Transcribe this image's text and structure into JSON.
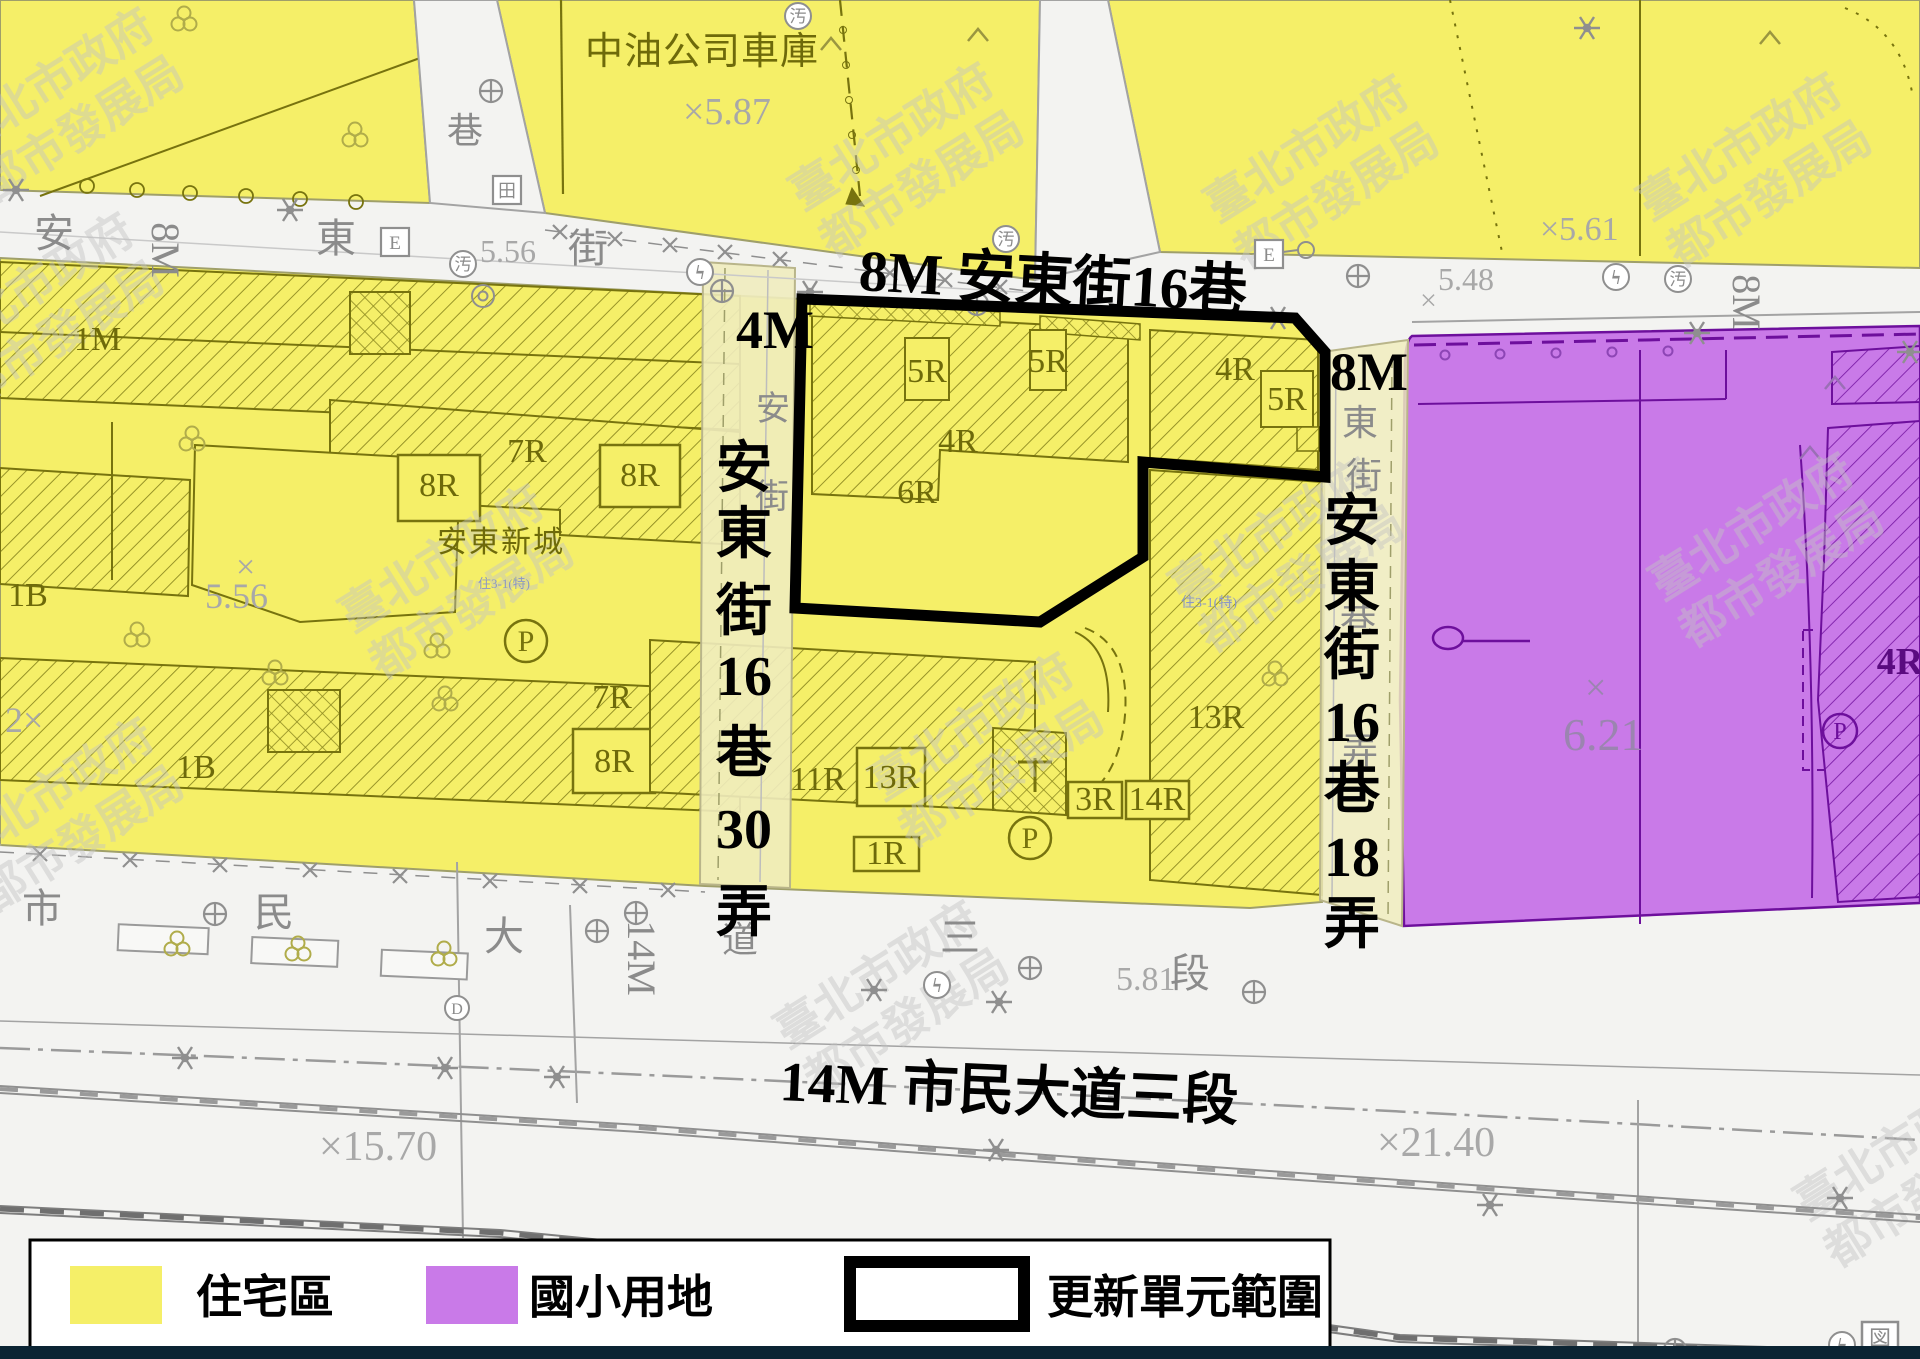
{
  "streets": {
    "andong_lane16": "8M  安東街16巷",
    "width_4m": "4M",
    "width_8m": "8M",
    "civic_blvd": "14M  市民大道三段",
    "lane30_chars": [
      "安",
      "東",
      "街",
      "16",
      "巷",
      "30",
      "弄"
    ],
    "lane18_chars": [
      "安",
      "東",
      "街",
      "16",
      "巷",
      "18",
      "弄"
    ],
    "gray": {
      "an": "安",
      "dong": "東",
      "jie": "街",
      "xiang": "巷",
      "nong": "弄",
      "dao": "道",
      "shi": "市",
      "min": "民",
      "da": "大",
      "san": "三",
      "duan": "段",
      "m8": "8M",
      "m14": "14M"
    }
  },
  "areas": {
    "cpc_depot": "中油公司車庫",
    "andong_village": "安東新城",
    "zoning_note": "住3-1(特)"
  },
  "elevations": {
    "e587": "×5.87",
    "e561": "×5.61",
    "e556_big": "5.56",
    "e556_x": "×",
    "e556_road": "5.56",
    "e548": "5.48",
    "x": "×",
    "e581": "5.81",
    "e621": "6.21",
    "e1570": "×15.70",
    "e2140": "×21.40",
    "e2x": "2×"
  },
  "parcels": {
    "m1": "1M",
    "b1": "1B",
    "r1": "1R",
    "r3": "3R",
    "r4": "4R",
    "r5": "5R",
    "r6": "6R",
    "r7": "7R",
    "r8": "8R",
    "r11": "11R",
    "r13": "13R",
    "r14": "14R"
  },
  "symbols": {
    "sewer": "汚",
    "power": "ϟ",
    "parking": "P",
    "drain": "D",
    "gas": "田",
    "electric": "E",
    "map_sheet": "図"
  },
  "legend": {
    "residential": "住宅區",
    "school": "國小用地",
    "renewal_unit": "更新單元範圍"
  },
  "watermark": {
    "line1": "臺北市政府",
    "line2": "都市發展局"
  },
  "colors": {
    "residential_yellow": "#f5ef68",
    "school_purple": "#c97ae8",
    "lane_pale": "#f0ecbe",
    "parcel_olive": "#77730e",
    "boundary_black": "#000000",
    "footer_navy": "#0b2433"
  }
}
